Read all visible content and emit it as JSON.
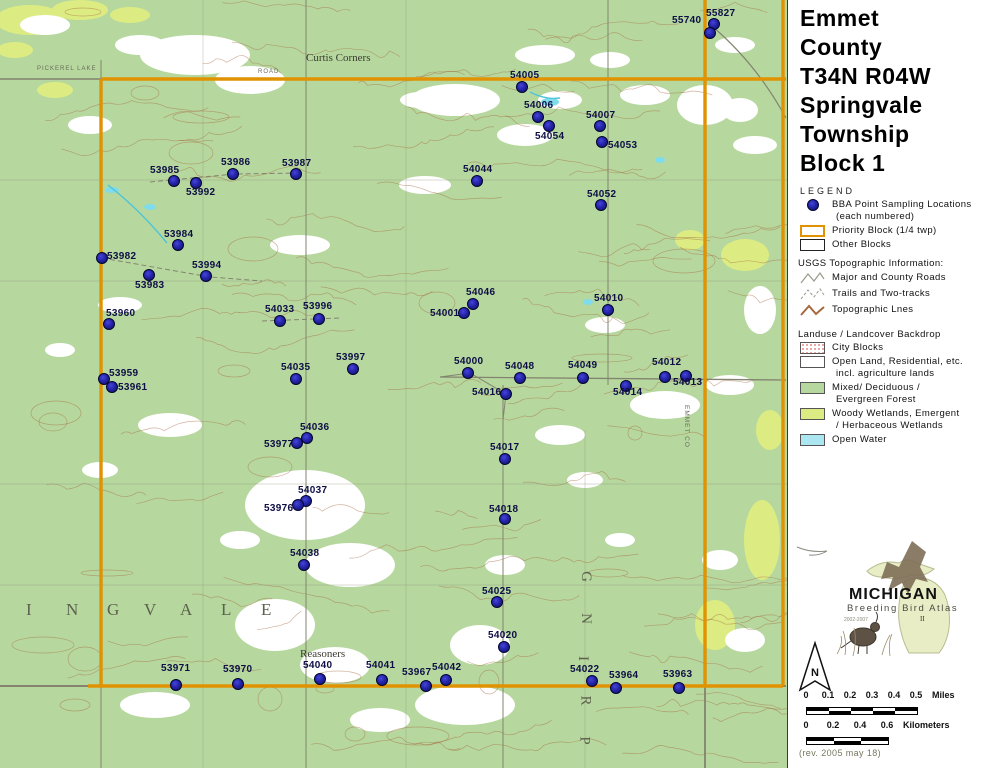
{
  "map": {
    "colors": {
      "forest": "#b6d89e",
      "wetland": "#dcec82",
      "water": "#a4e6f0",
      "contour": "#a5683f",
      "road": "#83836f",
      "priority_border": "#e09200",
      "point_fill": "#2424aa",
      "point_label": "#0e0e45"
    },
    "points": [
      {
        "id": "55827",
        "x": 714,
        "y": 24,
        "lx": 706,
        "ly": 8
      },
      {
        "id": "55740",
        "x": 710,
        "y": 33,
        "lx": 672,
        "ly": 15
      },
      {
        "id": "54005",
        "x": 522,
        "y": 87,
        "lx": 510,
        "ly": 70
      },
      {
        "id": "54006",
        "x": 538,
        "y": 117,
        "lx": 524,
        "ly": 100
      },
      {
        "id": "54054",
        "x": 549,
        "y": 126,
        "lx": 535,
        "ly": 131
      },
      {
        "id": "54007",
        "x": 600,
        "y": 126,
        "lx": 586,
        "ly": 110
      },
      {
        "id": "54053",
        "x": 602,
        "y": 142,
        "lx": 608,
        "ly": 140
      },
      {
        "id": "53985",
        "x": 174,
        "y": 181,
        "lx": 150,
        "ly": 165
      },
      {
        "id": "53992",
        "x": 196,
        "y": 183,
        "lx": 186,
        "ly": 187
      },
      {
        "id": "53986",
        "x": 233,
        "y": 174,
        "lx": 221,
        "ly": 157
      },
      {
        "id": "53987",
        "x": 296,
        "y": 174,
        "lx": 282,
        "ly": 158
      },
      {
        "id": "54044",
        "x": 477,
        "y": 181,
        "lx": 463,
        "ly": 164
      },
      {
        "id": "54052",
        "x": 601,
        "y": 205,
        "lx": 587,
        "ly": 189
      },
      {
        "id": "53984",
        "x": 178,
        "y": 245,
        "lx": 164,
        "ly": 229
      },
      {
        "id": "53982",
        "x": 102,
        "y": 258,
        "lx": 107,
        "ly": 251
      },
      {
        "id": "53983",
        "x": 149,
        "y": 275,
        "lx": 135,
        "ly": 280
      },
      {
        "id": "53994",
        "x": 206,
        "y": 276,
        "lx": 192,
        "ly": 260
      },
      {
        "id": "54046",
        "x": 473,
        "y": 304,
        "lx": 466,
        "ly": 287
      },
      {
        "id": "54001",
        "x": 464,
        "y": 313,
        "lx": 430,
        "ly": 308
      },
      {
        "id": "54010",
        "x": 608,
        "y": 310,
        "lx": 594,
        "ly": 293
      },
      {
        "id": "53960",
        "x": 109,
        "y": 324,
        "lx": 106,
        "ly": 308
      },
      {
        "id": "54033",
        "x": 280,
        "y": 321,
        "lx": 265,
        "ly": 304
      },
      {
        "id": "53996",
        "x": 319,
        "y": 319,
        "lx": 303,
        "ly": 301
      },
      {
        "id": "53959",
        "x": 104,
        "y": 379,
        "lx": 109,
        "ly": 368
      },
      {
        "id": "53961",
        "x": 112,
        "y": 387,
        "lx": 118,
        "ly": 382
      },
      {
        "id": "54035",
        "x": 296,
        "y": 379,
        "lx": 281,
        "ly": 362
      },
      {
        "id": "53997",
        "x": 353,
        "y": 369,
        "lx": 336,
        "ly": 352
      },
      {
        "id": "54000",
        "x": 468,
        "y": 373,
        "lx": 454,
        "ly": 356
      },
      {
        "id": "54048",
        "x": 520,
        "y": 378,
        "lx": 505,
        "ly": 361
      },
      {
        "id": "54049",
        "x": 583,
        "y": 378,
        "lx": 568,
        "ly": 360
      },
      {
        "id": "54012",
        "x": 665,
        "y": 377,
        "lx": 652,
        "ly": 357
      },
      {
        "id": "54013",
        "x": 686,
        "y": 376,
        "lx": 673,
        "ly": 377
      },
      {
        "id": "54016",
        "x": 506,
        "y": 394,
        "lx": 472,
        "ly": 387
      },
      {
        "id": "54014",
        "x": 626,
        "y": 386,
        "lx": 613,
        "ly": 387
      },
      {
        "id": "54036",
        "x": 307,
        "y": 438,
        "lx": 300,
        "ly": 422
      },
      {
        "id": "53977",
        "x": 297,
        "y": 443,
        "lx": 264,
        "ly": 439
      },
      {
        "id": "54017",
        "x": 505,
        "y": 459,
        "lx": 490,
        "ly": 442
      },
      {
        "id": "54037",
        "x": 306,
        "y": 501,
        "lx": 298,
        "ly": 485
      },
      {
        "id": "53976",
        "x": 298,
        "y": 505,
        "lx": 264,
        "ly": 503
      },
      {
        "id": "54018",
        "x": 505,
        "y": 519,
        "lx": 489,
        "ly": 504
      },
      {
        "id": "54038",
        "x": 304,
        "y": 565,
        "lx": 290,
        "ly": 548
      },
      {
        "id": "54025",
        "x": 497,
        "y": 602,
        "lx": 482,
        "ly": 586
      },
      {
        "id": "54020",
        "x": 504,
        "y": 647,
        "lx": 488,
        "ly": 630
      },
      {
        "id": "53971",
        "x": 176,
        "y": 685,
        "lx": 161,
        "ly": 663
      },
      {
        "id": "53970",
        "x": 238,
        "y": 684,
        "lx": 223,
        "ly": 664
      },
      {
        "id": "54040",
        "x": 320,
        "y": 679,
        "lx": 303,
        "ly": 660
      },
      {
        "id": "54041",
        "x": 382,
        "y": 680,
        "lx": 366,
        "ly": 660
      },
      {
        "id": "53967",
        "x": 426,
        "y": 686,
        "lx": 402,
        "ly": 667
      },
      {
        "id": "54042",
        "x": 446,
        "y": 680,
        "lx": 432,
        "ly": 662
      },
      {
        "id": "54022",
        "x": 592,
        "y": 681,
        "lx": 570,
        "ly": 664
      },
      {
        "id": "53964",
        "x": 616,
        "y": 688,
        "lx": 609,
        "ly": 670
      },
      {
        "id": "53963",
        "x": 679,
        "y": 688,
        "lx": 663,
        "ly": 669
      }
    ],
    "place_labels": {
      "curtis_corners": "Curtis Corners",
      "reasoners": "Reasoners",
      "pickerel": "PICKEREL LAKE",
      "road": "ROAD",
      "emmet_co": "EMMET CO",
      "springvale_across": [
        "I",
        "N",
        "G",
        "V",
        "A",
        "L",
        "E"
      ],
      "springvale_vertical": [
        "G",
        "N",
        "I",
        "R",
        "P"
      ]
    }
  },
  "panel": {
    "title_lines": [
      "Emmet",
      "County",
      "T34N R04W",
      "Springvale",
      "Township",
      "Block 1"
    ],
    "legend": {
      "title": "LEGEND",
      "bba_line1": "BBA Point Sampling Locations",
      "bba_line2": "(each numbered)",
      "priority": "Priority Block (1/4 twp)",
      "other": "Other Blocks",
      "usgs_header": "USGS Topographic Information:",
      "roads": "Major and County Roads",
      "trails": "Trails and Two-tracks",
      "topo": "Topographic Lnes"
    },
    "landuse": {
      "header": "Landuse / Landcover Backdrop",
      "city": "City Blocks",
      "open_line1": "Open Land, Residential, etc.",
      "open_line2": "incl. agriculture lands",
      "forest_line1": "Mixed/ Deciduous /",
      "forest_line2": "Evergreen Forest",
      "wetland_line1": "Woody Wetlands, Emergent",
      "wetland_line2": "/ Herbaceous Wetlands",
      "water": "Open Water"
    },
    "logo": {
      "title": "MICHIGAN",
      "subtitle": "Breeding Bird Atlas",
      "years": "2002-2007",
      "numeral": "II"
    },
    "north_label": "N",
    "scales": {
      "miles": {
        "ticks": [
          "0",
          "0.1",
          "0.2",
          "0.3",
          "0.4",
          "0.5"
        ],
        "unit": "Miles"
      },
      "kilometers": {
        "ticks": [
          "0",
          "0.2",
          "0.4",
          "0.6"
        ],
        "unit": "Kilometers"
      }
    },
    "revision": "(rev. 2005 may 18)"
  }
}
